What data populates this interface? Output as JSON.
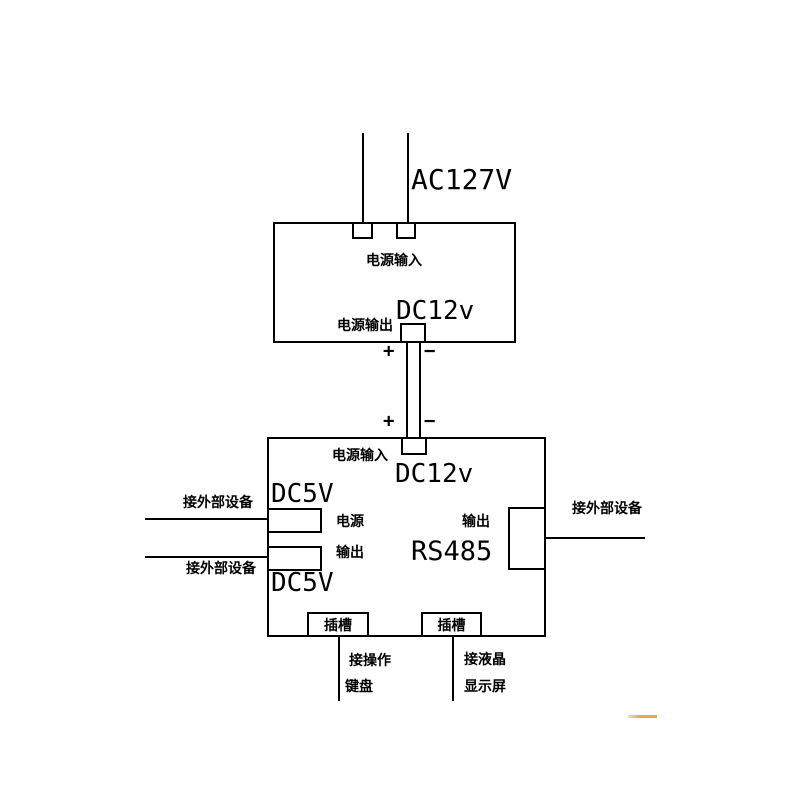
{
  "colors": {
    "line": "#000000",
    "background": "#ffffff",
    "artifact": "#e8a94c"
  },
  "top_section": {
    "ac_voltage": "AC127V"
  },
  "psu_box": {
    "input_label": "电源输入",
    "output_voltage": "DC12v",
    "output_label": "电源输出"
  },
  "wire": {
    "plus_top": "+",
    "minus_top": "−",
    "plus_bottom": "+",
    "minus_bottom": "−"
  },
  "main_box": {
    "input_label": "电源输入",
    "input_voltage": "DC12v",
    "dc5v_top": "DC5V",
    "power_label": "电源",
    "output_label": "输出",
    "dc5v_bottom": "DC5V",
    "rs485_output_label": "输出",
    "rs485_label": "RS485",
    "slot_left_label": "插槽",
    "slot_right_label": "插槽"
  },
  "external": {
    "left_top_label": "接外部设备",
    "left_bottom_label": "接外部设备",
    "right_label": "接外部设备",
    "keyboard_label_line1": "接操作",
    "keyboard_label_line2": "键盘",
    "lcd_label_line1": "接液晶",
    "lcd_label_line2": "显示屏"
  }
}
